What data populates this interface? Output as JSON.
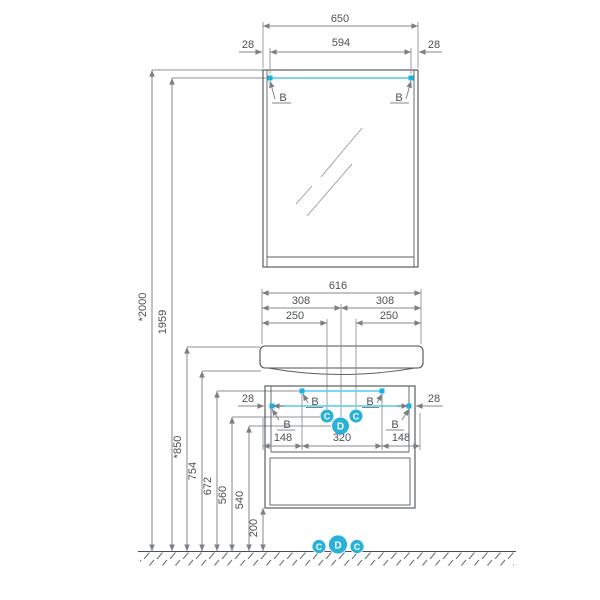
{
  "labels": {
    "bracket": "B",
    "supply": "C",
    "drain": "D"
  },
  "dims": {
    "mirror": {
      "overall": "650",
      "brackets": "594",
      "offset_left": "28",
      "offset_right": "28"
    },
    "heights": {
      "total": "*2000",
      "mirror_bracket": "1959",
      "basin_top": "*850",
      "basin_bottom": "754",
      "cabinet_bracket": "672",
      "supply_height": "560",
      "drain_height": "540",
      "cabinet_bottom": "200"
    },
    "basin": {
      "overall": "616",
      "center_left": "308",
      "center_right": "308",
      "supply_left": "250",
      "supply_right": "250"
    },
    "cabinet": {
      "offset_left": "28",
      "offset_right": "28",
      "bracket_left": "148",
      "bracket_span": "320",
      "bracket_right": "148"
    }
  },
  "colors": {
    "accent_cyan": "#17b2de",
    "line_gray": "#4b5054",
    "dim_gray": "#83878b"
  }
}
